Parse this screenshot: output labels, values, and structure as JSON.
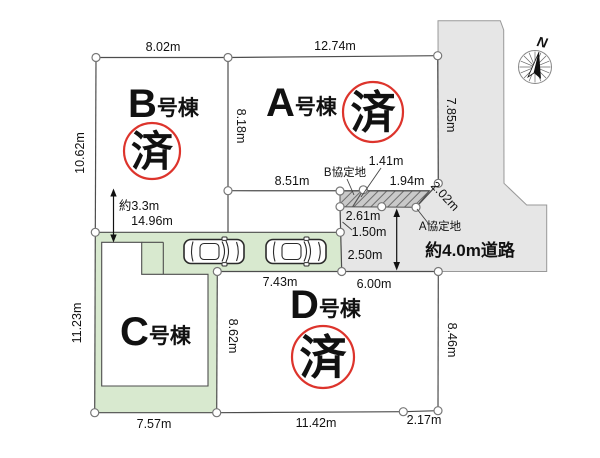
{
  "plots": {
    "b": {
      "letter": "B",
      "suffix": "号棟",
      "stamp": "済"
    },
    "a": {
      "letter": "A",
      "suffix": "号棟",
      "stamp": "済"
    },
    "c": {
      "letter": "C",
      "suffix": "号棟"
    },
    "d": {
      "letter": "D",
      "suffix": "号棟",
      "stamp": "済"
    }
  },
  "dimensions": {
    "b_top": "8.02m",
    "a_top": "12.74m",
    "b_left": "10.62m",
    "ab_boundary": "8.18m",
    "a_right": "7.85m",
    "a_bottom": "8.51m",
    "b_setback": "約3.3m",
    "parking_top": "14.96m",
    "agreement_sep": "1.41m",
    "agreement_top": "1.94m",
    "agreement_diag": "2.02m",
    "agreement_bottom": "2.61m",
    "road_seg1": "1.50m",
    "road_seg2": "2.50m",
    "d_top": "6.00m",
    "parking_bottom": "7.43m",
    "c_left": "11.23m",
    "c_bottom": "7.57m",
    "cd_boundary": "8.62m",
    "d_right": "8.46m",
    "d_bottom": "11.42m",
    "d_bottom_corner": "2.17m"
  },
  "labels": {
    "b_agreement": "B協定地",
    "a_agreement": "A協定地",
    "road": "約4.0m道路",
    "compass_north": "N"
  },
  "colors": {
    "plot_green": "#d8e9cf",
    "road_gray": "#e6e6e6",
    "hatch_gray": "#c9c9c9",
    "stamp_red": "#dd342c",
    "line": "#4d4d4d"
  }
}
